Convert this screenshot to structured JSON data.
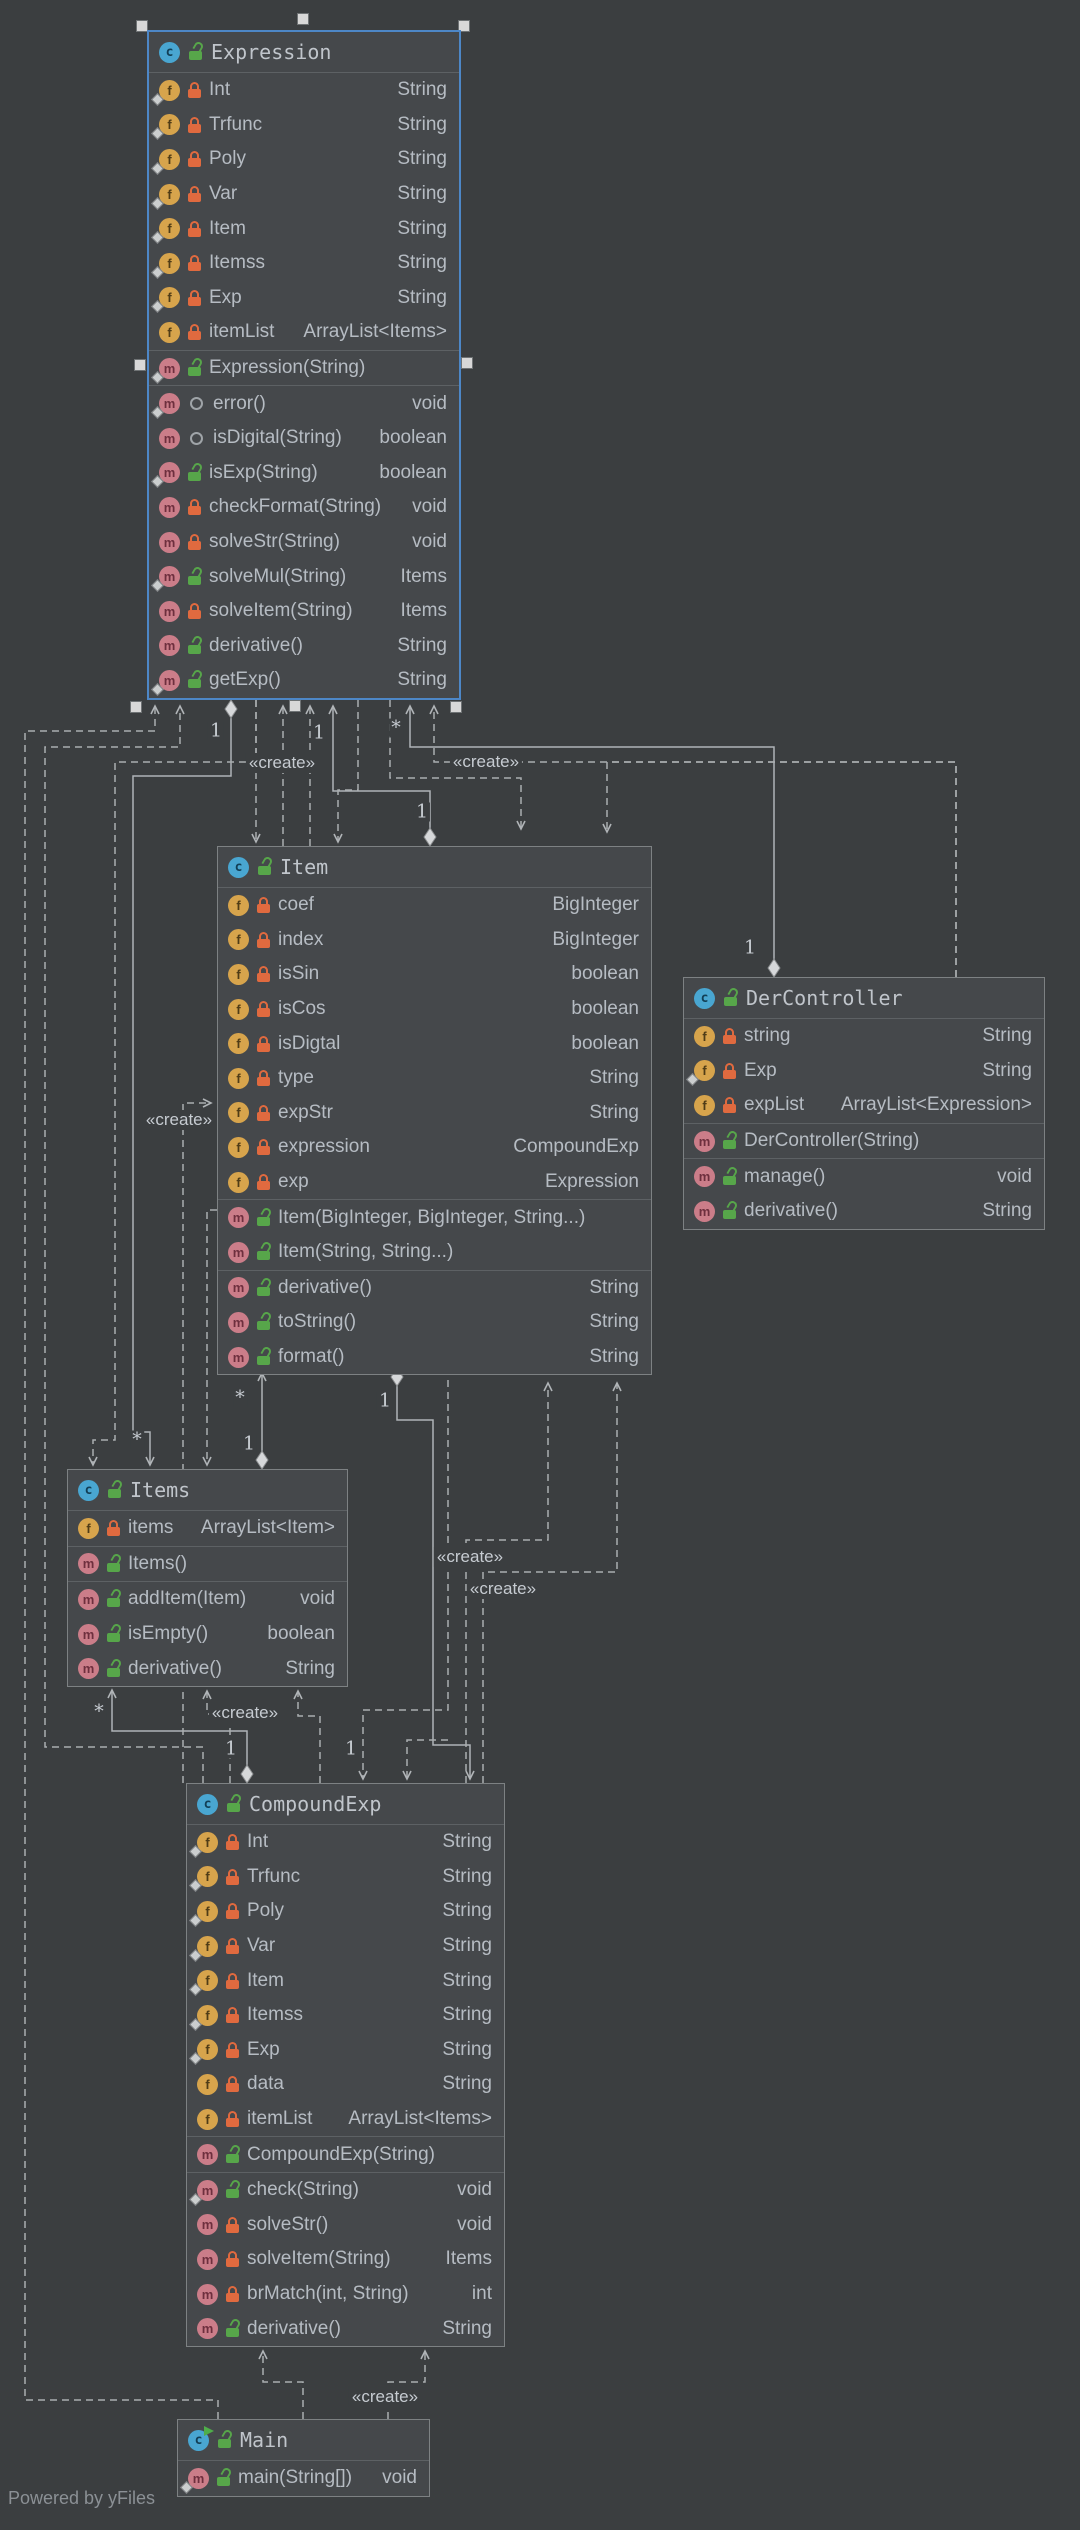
{
  "watermark": "Powered by yFiles",
  "colors": {
    "background": "#3b3e40",
    "node_fill": "#45484b",
    "node_border": "#7d8183",
    "selected_border": "#4d87c7",
    "text": "#b6bcc3",
    "field_icon": "#d7a44c",
    "method_icon": "#cb7d89",
    "class_icon": "#49a6d1",
    "private_lock": "#e06a3f",
    "public_lock": "#57a64a",
    "edge": "#b0b4b7"
  },
  "classes": [
    {
      "id": "Expression",
      "name": "Expression",
      "selected": true,
      "main_class": false,
      "fields": [
        {
          "name": "Int",
          "type": "String",
          "visibility": "private",
          "final": true
        },
        {
          "name": "Trfunc",
          "type": "String",
          "visibility": "private",
          "final": true
        },
        {
          "name": "Poly",
          "type": "String",
          "visibility": "private",
          "final": true
        },
        {
          "name": "Var",
          "type": "String",
          "visibility": "private",
          "final": true
        },
        {
          "name": "Item",
          "type": "String",
          "visibility": "private",
          "final": true
        },
        {
          "name": "Itemss",
          "type": "String",
          "visibility": "private",
          "final": true
        },
        {
          "name": "Exp",
          "type": "String",
          "visibility": "private",
          "final": true
        },
        {
          "name": "itemList",
          "type": "ArrayList<Items>",
          "visibility": "private",
          "final": false
        }
      ],
      "constructors": [
        {
          "name": "Expression(String)",
          "type": "",
          "visibility": "public",
          "final": true
        }
      ],
      "methods": [
        {
          "name": "error()",
          "type": "void",
          "visibility": "package",
          "final": true
        },
        {
          "name": "isDigital(String)",
          "type": "boolean",
          "visibility": "package",
          "final": false
        },
        {
          "name": "isExp(String)",
          "type": "boolean",
          "visibility": "public",
          "final": true
        },
        {
          "name": "checkFormat(String)",
          "type": "void",
          "visibility": "private",
          "final": false
        },
        {
          "name": "solveStr(String)",
          "type": "void",
          "visibility": "private",
          "final": false
        },
        {
          "name": "solveMul(String)",
          "type": "Items",
          "visibility": "public",
          "final": true
        },
        {
          "name": "solveItem(String)",
          "type": "Items",
          "visibility": "private",
          "final": false
        },
        {
          "name": "derivative()",
          "type": "String",
          "visibility": "public",
          "final": false
        },
        {
          "name": "getExp()",
          "type": "String",
          "visibility": "public",
          "final": true
        }
      ]
    },
    {
      "id": "Item",
      "name": "Item",
      "selected": false,
      "main_class": false,
      "fields": [
        {
          "name": "coef",
          "type": "BigInteger",
          "visibility": "private",
          "final": false
        },
        {
          "name": "index",
          "type": "BigInteger",
          "visibility": "private",
          "final": false
        },
        {
          "name": "isSin",
          "type": "boolean",
          "visibility": "private",
          "final": false
        },
        {
          "name": "isCos",
          "type": "boolean",
          "visibility": "private",
          "final": false
        },
        {
          "name": "isDigtal",
          "type": "boolean",
          "visibility": "private",
          "final": false
        },
        {
          "name": "type",
          "type": "String",
          "visibility": "private",
          "final": false
        },
        {
          "name": "expStr",
          "type": "String",
          "visibility": "private",
          "final": false
        },
        {
          "name": "expression",
          "type": "CompoundExp",
          "visibility": "private",
          "final": false
        },
        {
          "name": "exp",
          "type": "Expression",
          "visibility": "private",
          "final": false
        }
      ],
      "constructors": [
        {
          "name": "Item(BigInteger, BigInteger, String...)",
          "type": "",
          "visibility": "public",
          "final": false
        },
        {
          "name": "Item(String, String...)",
          "type": "",
          "visibility": "public",
          "final": false
        }
      ],
      "methods": [
        {
          "name": "derivative()",
          "type": "String",
          "visibility": "public",
          "final": false
        },
        {
          "name": "toString()",
          "type": "String",
          "visibility": "public",
          "final": false
        },
        {
          "name": "format()",
          "type": "String",
          "visibility": "public",
          "final": false
        }
      ]
    },
    {
      "id": "DerController",
      "name": "DerController",
      "selected": false,
      "main_class": false,
      "fields": [
        {
          "name": "string",
          "type": "String",
          "visibility": "private",
          "final": false
        },
        {
          "name": "Exp",
          "type": "String",
          "visibility": "private",
          "final": true
        },
        {
          "name": "expList",
          "type": "ArrayList<Expression>",
          "visibility": "private",
          "final": false
        }
      ],
      "constructors": [
        {
          "name": "DerController(String)",
          "type": "",
          "visibility": "public",
          "final": false
        }
      ],
      "methods": [
        {
          "name": "manage()",
          "type": "void",
          "visibility": "public",
          "final": false
        },
        {
          "name": "derivative()",
          "type": "String",
          "visibility": "public",
          "final": false
        }
      ]
    },
    {
      "id": "Items",
      "name": "Items",
      "selected": false,
      "main_class": false,
      "fields": [
        {
          "name": "items",
          "type": "ArrayList<Item>",
          "visibility": "private",
          "final": false
        }
      ],
      "constructors": [
        {
          "name": "Items()",
          "type": "",
          "visibility": "public",
          "final": false
        }
      ],
      "methods": [
        {
          "name": "addItem(Item)",
          "type": "void",
          "visibility": "public",
          "final": false
        },
        {
          "name": "isEmpty()",
          "type": "boolean",
          "visibility": "public",
          "final": false
        },
        {
          "name": "derivative()",
          "type": "String",
          "visibility": "public",
          "final": false
        }
      ]
    },
    {
      "id": "CompoundExp",
      "name": "CompoundExp",
      "selected": false,
      "main_class": false,
      "fields": [
        {
          "name": "Int",
          "type": "String",
          "visibility": "private",
          "final": true
        },
        {
          "name": "Trfunc",
          "type": "String",
          "visibility": "private",
          "final": true
        },
        {
          "name": "Poly",
          "type": "String",
          "visibility": "private",
          "final": true
        },
        {
          "name": "Var",
          "type": "String",
          "visibility": "private",
          "final": true
        },
        {
          "name": "Item",
          "type": "String",
          "visibility": "private",
          "final": true
        },
        {
          "name": "Itemss",
          "type": "String",
          "visibility": "private",
          "final": true
        },
        {
          "name": "Exp",
          "type": "String",
          "visibility": "private",
          "final": true
        },
        {
          "name": "data",
          "type": "String",
          "visibility": "private",
          "final": false
        },
        {
          "name": "itemList",
          "type": "ArrayList<Items>",
          "visibility": "private",
          "final": false
        }
      ],
      "constructors": [
        {
          "name": "CompoundExp(String)",
          "type": "",
          "visibility": "public",
          "final": false
        }
      ],
      "methods": [
        {
          "name": "check(String)",
          "type": "void",
          "visibility": "public",
          "final": true
        },
        {
          "name": "solveStr()",
          "type": "void",
          "visibility": "private",
          "final": false
        },
        {
          "name": "solveItem(String)",
          "type": "Items",
          "visibility": "private",
          "final": false
        },
        {
          "name": "brMatch(int, String)",
          "type": "int",
          "visibility": "private",
          "final": false
        },
        {
          "name": "derivative()",
          "type": "String",
          "visibility": "public",
          "final": false
        }
      ]
    },
    {
      "id": "Main",
      "name": "Main",
      "selected": false,
      "main_class": true,
      "fields": [],
      "constructors": [],
      "methods": [
        {
          "name": "main(String[])",
          "type": "void",
          "visibility": "public",
          "final": true
        }
      ]
    }
  ],
  "edge_labels": {
    "create_text": "«create»",
    "creates": [
      {
        "x": 282,
        "y": 763
      },
      {
        "x": 486,
        "y": 762
      },
      {
        "x": 179,
        "y": 1120
      },
      {
        "x": 470,
        "y": 1557
      },
      {
        "x": 503,
        "y": 1589
      },
      {
        "x": 245,
        "y": 1713
      },
      {
        "x": 385,
        "y": 2397
      }
    ],
    "multiplicities": [
      {
        "text": "1",
        "x": 216,
        "y": 731
      },
      {
        "text": "1",
        "x": 319,
        "y": 733
      },
      {
        "text": "*",
        "x": 396,
        "y": 728
      },
      {
        "text": "1",
        "x": 422,
        "y": 812
      },
      {
        "text": "1",
        "x": 750,
        "y": 948
      },
      {
        "text": "*",
        "x": 137,
        "y": 1440
      },
      {
        "text": "*",
        "x": 240,
        "y": 1398
      },
      {
        "text": "1",
        "x": 249,
        "y": 1444
      },
      {
        "text": "1",
        "x": 385,
        "y": 1401
      },
      {
        "text": "*",
        "x": 99,
        "y": 1712
      },
      {
        "text": "1",
        "x": 231,
        "y": 1749
      },
      {
        "text": "1",
        "x": 351,
        "y": 1749
      }
    ]
  }
}
